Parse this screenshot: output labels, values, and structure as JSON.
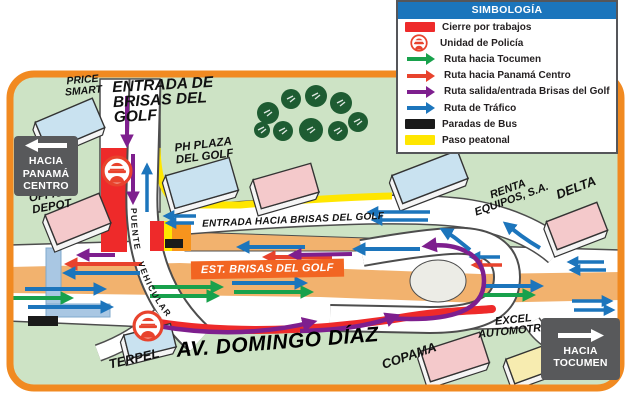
{
  "legend": {
    "title": "SIMBOLOGÍA",
    "items": [
      {
        "label": "Cierre por trabajos",
        "swatch": "rect-red"
      },
      {
        "label": "Unidad de Policía",
        "swatch": "police"
      },
      {
        "label": "Ruta hacia Tocumen",
        "swatch": "arrow-green"
      },
      {
        "label": "Ruta hacia Panamá Centro",
        "swatch": "arrow-red"
      },
      {
        "label": "Ruta salida/entrada Brisas del Golf",
        "swatch": "arrow-purple"
      },
      {
        "label": "Ruta de Tráfico",
        "swatch": "arrow-blue"
      },
      {
        "label": "Paradas de Bus",
        "swatch": "rect-black"
      },
      {
        "label": "Paso peatonal",
        "swatch": "rect-yellow"
      }
    ]
  },
  "map": {
    "labels": {
      "price_smart": "PRICE\nSMART",
      "entrada_brisas": "ENTRADA DE\nBRISAS DEL\nGOLF",
      "ph_plaza": "PH PLAZA\nDEL GOLF",
      "office_depot": "OFFICE\nDEPOT",
      "renta_equipos": "RENTA\nEQUIPOS, S.A.",
      "delta": "DELTA",
      "entrada_hacia": "ENTRADA HACIA BRISAS DEL GOLF",
      "est_brisas": "EST. BRISAS DEL GOLF",
      "puente_vehicular": "PUENTE VEHICULAR",
      "av_domingo": "AV. DOMINGO DÍAZ",
      "terpel": "TERPEL",
      "copama": "COPAMA",
      "excel": "EXCEL\nAUTOMOTRIZ"
    },
    "signs": {
      "west": "HACIA\nPANAMÁ\nCENTRO",
      "east": "HACIA\nTOCUMEN"
    }
  },
  "colors": {
    "closure_red": "#ee2a2a",
    "route_tocumen_green": "#18a14c",
    "route_panama_red": "#e8432d",
    "route_brisas_purple": "#7e1f8e",
    "route_traffic_blue": "#1c75bc",
    "bus_stop_black": "#1a1a1a",
    "crosswalk_yellow": "#ffe600",
    "legend_header_blue": "#1b75bc",
    "map_border_orange": "#f18a21",
    "median_tan": "#f2b26e",
    "map_green": "#cde3c5"
  }
}
